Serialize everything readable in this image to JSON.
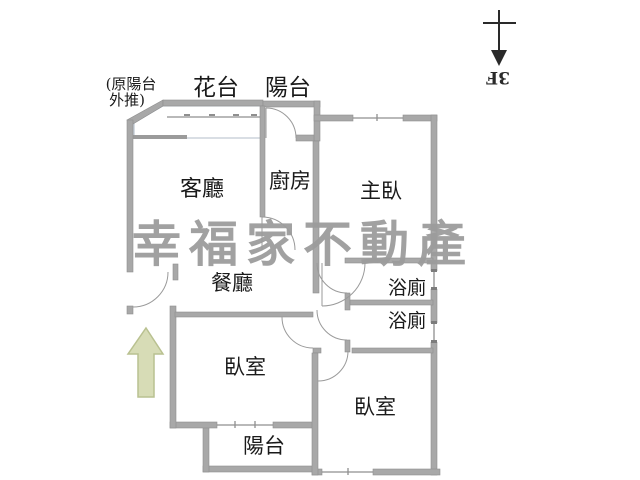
{
  "floorplan": {
    "note": {
      "line1": "(原陽台",
      "line2": "外推)"
    },
    "compass_label": "3F",
    "watermark": "幸福家不動產",
    "rooms": {
      "flower_bed": "花台",
      "top_balcony": "陽台",
      "living_room": "客廳",
      "kitchen": "廚房",
      "master_bedroom": "主臥",
      "dining_room": "餐廳",
      "bathroom_upper": "浴廁",
      "bathroom_lower": "浴廁",
      "bedroom_left": "臥室",
      "bedroom_right": "臥室",
      "bottom_balcony": "陽台"
    },
    "colors": {
      "wall": "#a8a8a8",
      "window_band": "#cddcec",
      "entrance_arrow": "#d7dcb6",
      "watermark": "#9c9c9c",
      "line": "#8f8f8f",
      "text": "#1a1a1a"
    }
  }
}
